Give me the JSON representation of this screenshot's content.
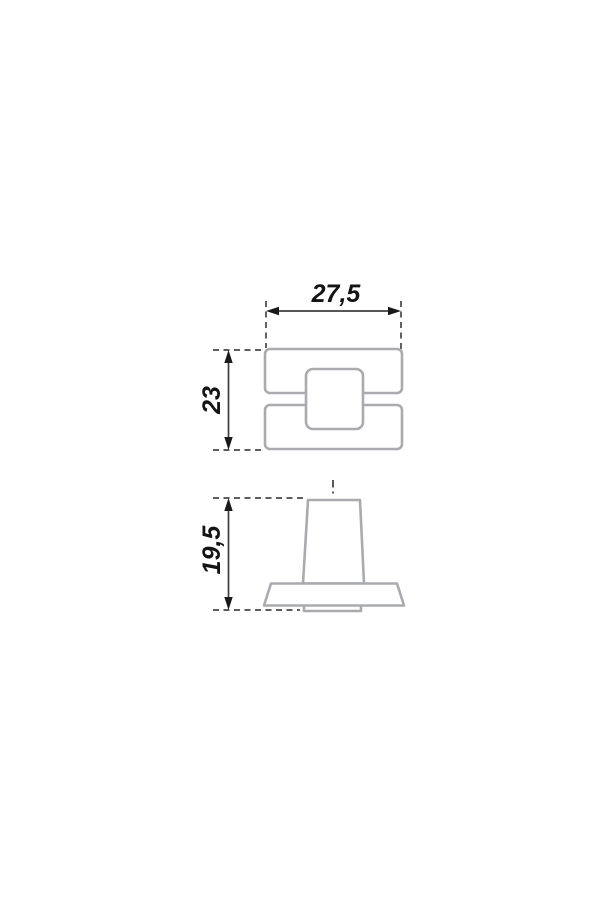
{
  "drawing": {
    "kind": "orthographic-dimension-drawing",
    "dimensions": {
      "top_width": "27,5",
      "top_height": "23",
      "side_height": "19,5"
    },
    "colors": {
      "background": "#ffffff",
      "part_outline": "#a9abae",
      "dimension_line": "#3f3f3f",
      "arrow": "#1a1a1a",
      "label_text": "#141414"
    }
  }
}
